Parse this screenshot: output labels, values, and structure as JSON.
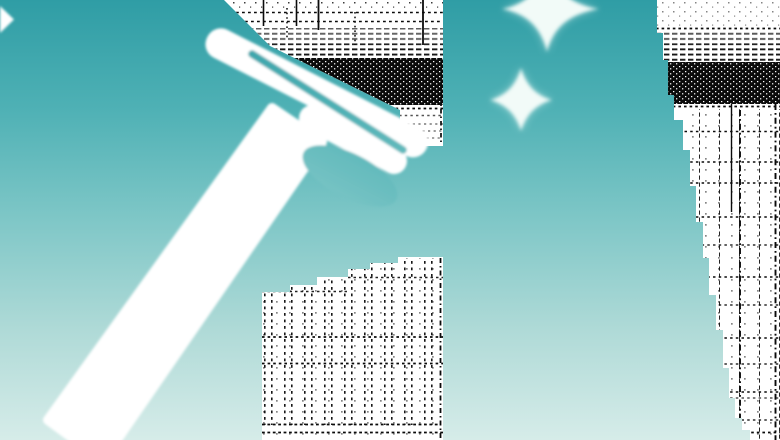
{
  "meta": {
    "type": "illustration",
    "alt": "Stylized editorial illustration: a white window squeegee with a long diagonal handle wipes across a teal gradient sky; white skyscrapers rendered in black halftone dither stand at the right edge, behind the squeegee head and at bottom center; two white four-point sparkles shine near the top."
  },
  "colors": {
    "bg_top": "#2F9DA5",
    "bg_q1": "#4FB1B5",
    "bg_mid": "#7FC7C7",
    "bg_q3": "#AFDAD7",
    "bg_bottom": "#D6ECE9",
    "white": "#FFFFFF",
    "sparkle": "#F2FBF8",
    "ink": "#0B0B0B"
  },
  "elements": {
    "background": "vertical teal gradient sky, dark at top fading to pale mint at bottom",
    "squeegee": "white window squeegee, blade angled down-right, chunky handle running to bottom-left corner",
    "sparkle_large": "four-point sparkle cropped by top edge, upper center-right",
    "sparkle_small": "smaller four-point sparkle below it",
    "corner_fragment": "small white sparkle fragment at top-left edge",
    "building_behind_head": "white tower behind squeegee head, horizontal dash dither and dense black band",
    "building_right": "tall white tower along right edge with stepped silhouette, dense dither band and dotted window grid",
    "building_center": "stepped white tower at bottom center with dotted window columns"
  }
}
